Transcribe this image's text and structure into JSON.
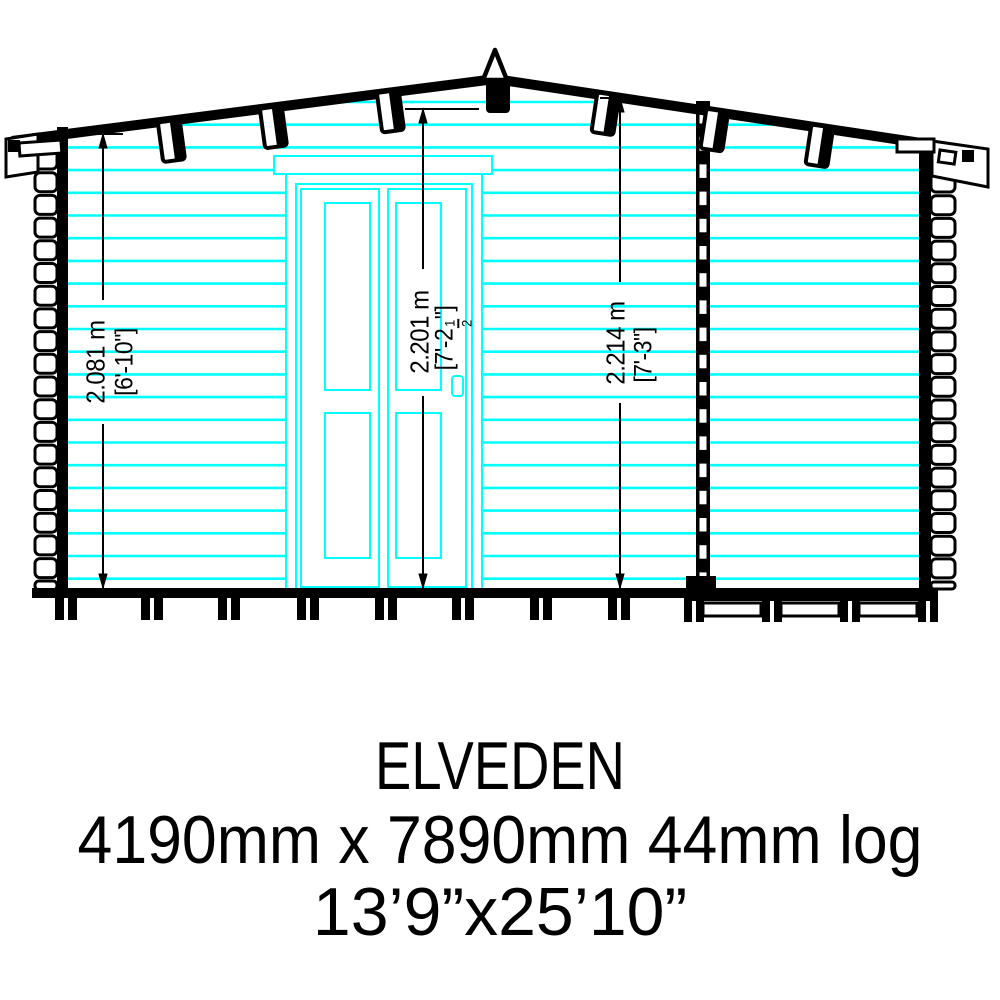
{
  "drawing": {
    "view": "front-elevation"
  },
  "colors": {
    "log_line": "#00ffff",
    "ink": "#000000",
    "background": "#ffffff"
  },
  "dimensions": [
    {
      "meters": "2.081 m",
      "imperial": "[6'-10\"]"
    },
    {
      "meters": "2.201 m",
      "imperial_prefix": "[7'-2",
      "fraction_num": "1",
      "fraction_den": "2",
      "imperial_suffix": "\"]"
    },
    {
      "meters": "2.214 m",
      "imperial": "[7'-3\"]"
    }
  ],
  "title_block": {
    "model_name": "ELVEDEN",
    "size_metric": "4190mm x 7890mm 44mm log",
    "size_imperial": "13’9”x25’10”"
  }
}
